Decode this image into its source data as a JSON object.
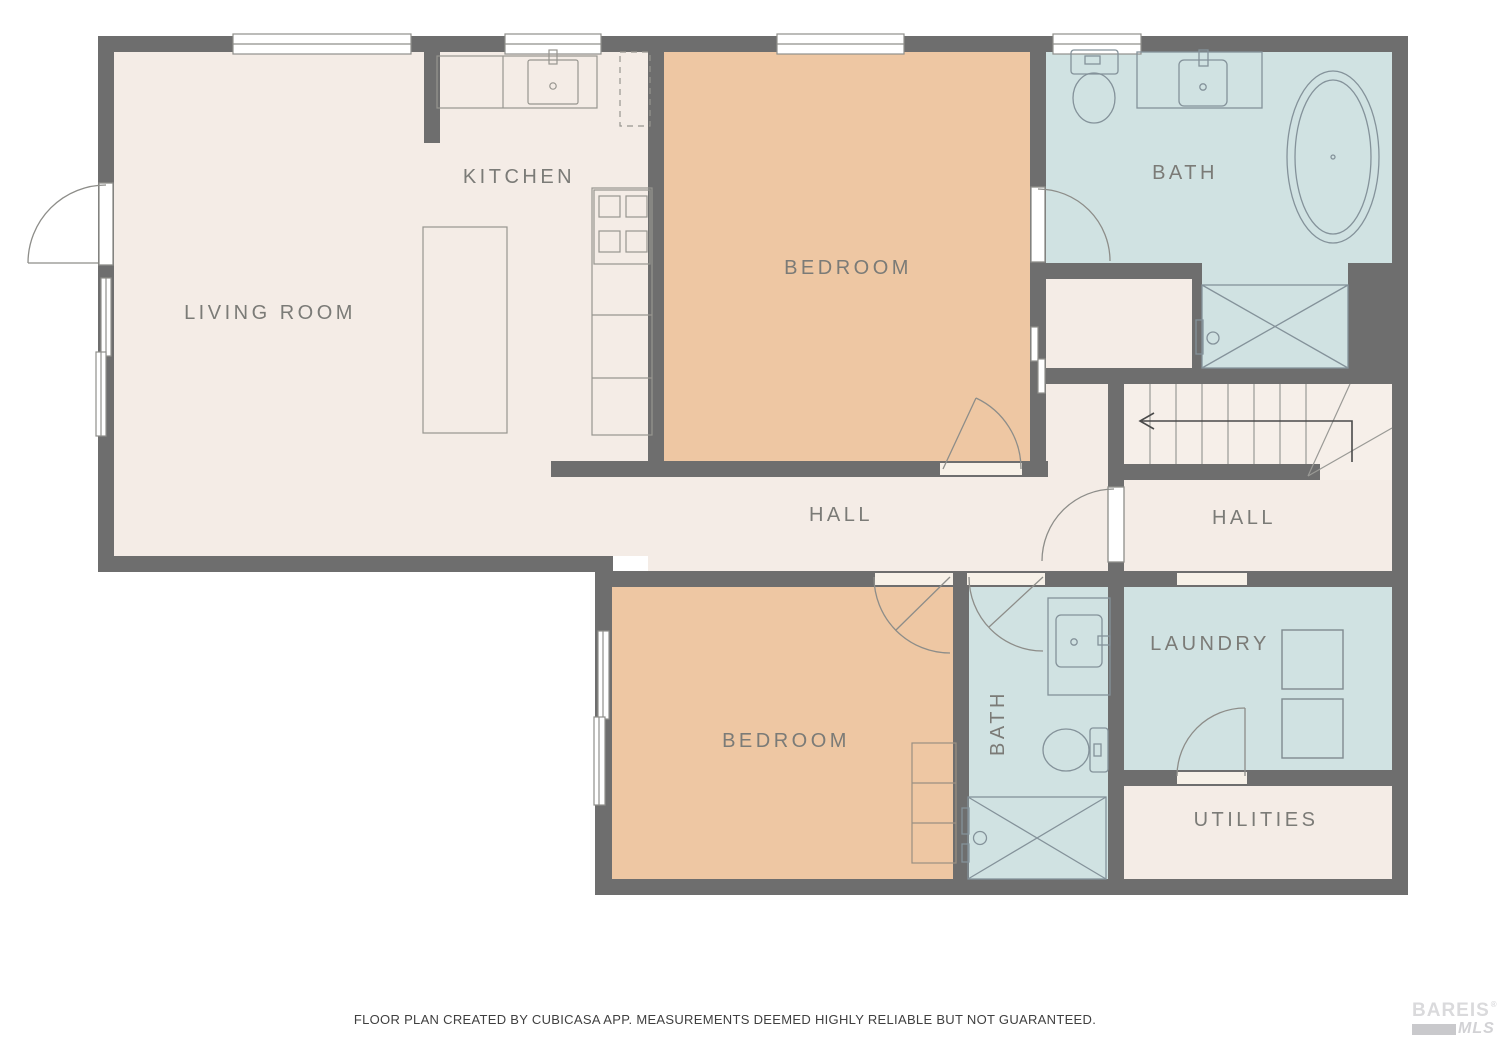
{
  "plan": {
    "title": "floor-plan",
    "rooms": {
      "living_room": {
        "label": "LIVING ROOM"
      },
      "kitchen": {
        "label": "KITCHEN"
      },
      "bedroom_top": {
        "label": "BEDROOM"
      },
      "bath_top": {
        "label": "BATH"
      },
      "hall_main": {
        "label": "HALL"
      },
      "hall_right": {
        "label": "HALL"
      },
      "bedroom_bottom": {
        "label": "BEDROOM"
      },
      "bath_bottom": {
        "label": "BATH"
      },
      "laundry": {
        "label": "LAUNDRY"
      },
      "utilities": {
        "label": "UTILITIES"
      }
    },
    "colors": {
      "wall": "#6e6e6e",
      "floor_cream": "#f4ece6",
      "floor_orange": "#eec7a3",
      "floor_blue": "#d0e2e2",
      "label_text": "#7b7b77",
      "fixture_line": "#8e969a",
      "stairs_arrow": "#4a4a4a"
    }
  },
  "footer": {
    "disclaimer": "FLOOR PLAN CREATED BY CUBICASA APP. MEASUREMENTS DEEMED HIGHLY RELIABLE BUT NOT GUARANTEED."
  },
  "logo": {
    "name": "BAREIS",
    "reg": "®",
    "mls": "MLS"
  }
}
